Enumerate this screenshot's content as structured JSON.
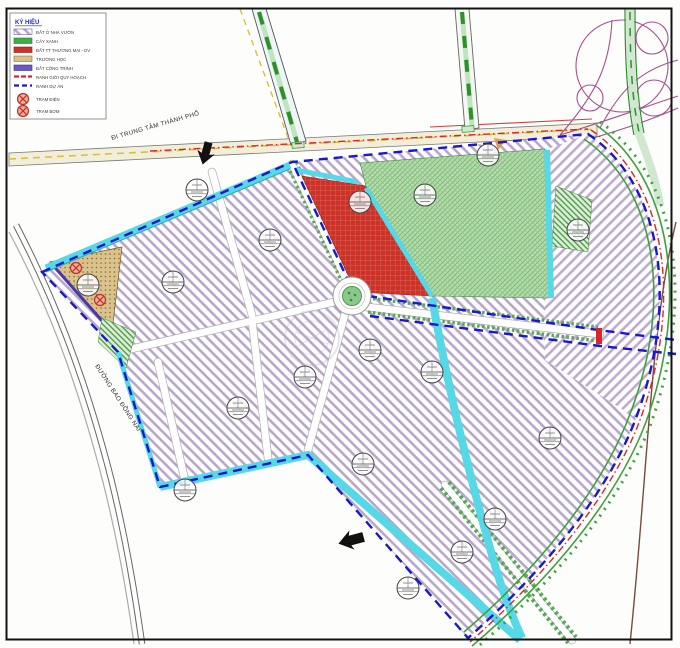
{
  "legend": {
    "title": "KÝ HIỆU",
    "items": [
      {
        "label": "ĐẤT Ở NHÀ VƯỜN",
        "swatch": "residential-hatch",
        "color": "#b9a6cb"
      },
      {
        "label": "CÂY XANH",
        "swatch": "solid",
        "color": "#3fae49"
      },
      {
        "label": "ĐẤT TT THƯƠNG MẠI - DV",
        "swatch": "solid",
        "color": "#cb3329"
      },
      {
        "label": "TRƯỜNG HỌC",
        "swatch": "solid",
        "color": "#d9c28c"
      },
      {
        "label": "ĐẤT CÔNG TRÌNH",
        "swatch": "solid",
        "color": "#6a5ac0"
      },
      {
        "label": "RANH GIỚI QUY HOẠCH",
        "swatch": "dashed-line",
        "color": "#d62828"
      },
      {
        "label": "RANH DỰ ÁN",
        "swatch": "dashed-line",
        "color": "#1818cc"
      },
      {
        "label": "TRẠM ĐIỆN",
        "swatch": "station-symbol",
        "color": "#c03028"
      },
      {
        "label": "TRẠM BƠM",
        "swatch": "station-symbol",
        "color": "#c03028"
      }
    ]
  },
  "labels": {
    "to_city_center": "ĐI TRUNG TÂM THÀNH PHỐ",
    "ring_road": "ĐƯỜNG BAO ĐỒNG NAI"
  },
  "colors": {
    "residential_hatch": "#b9a6cb",
    "park_green": "#b6dcae",
    "commercial_red": "#cb3329",
    "school_tan": "#d9c28c",
    "utility_blue": "#6a5ac0",
    "canal_cyan": "#56d8e6",
    "boundary_blue_dash": "#1818cc",
    "boundary_red_dash": "#d62828",
    "ring_road_green": "#3da23d",
    "highway_centerline_yellow": "#d6c23c",
    "interchange_purple": "#a85090",
    "frame_black": "#111111"
  }
}
